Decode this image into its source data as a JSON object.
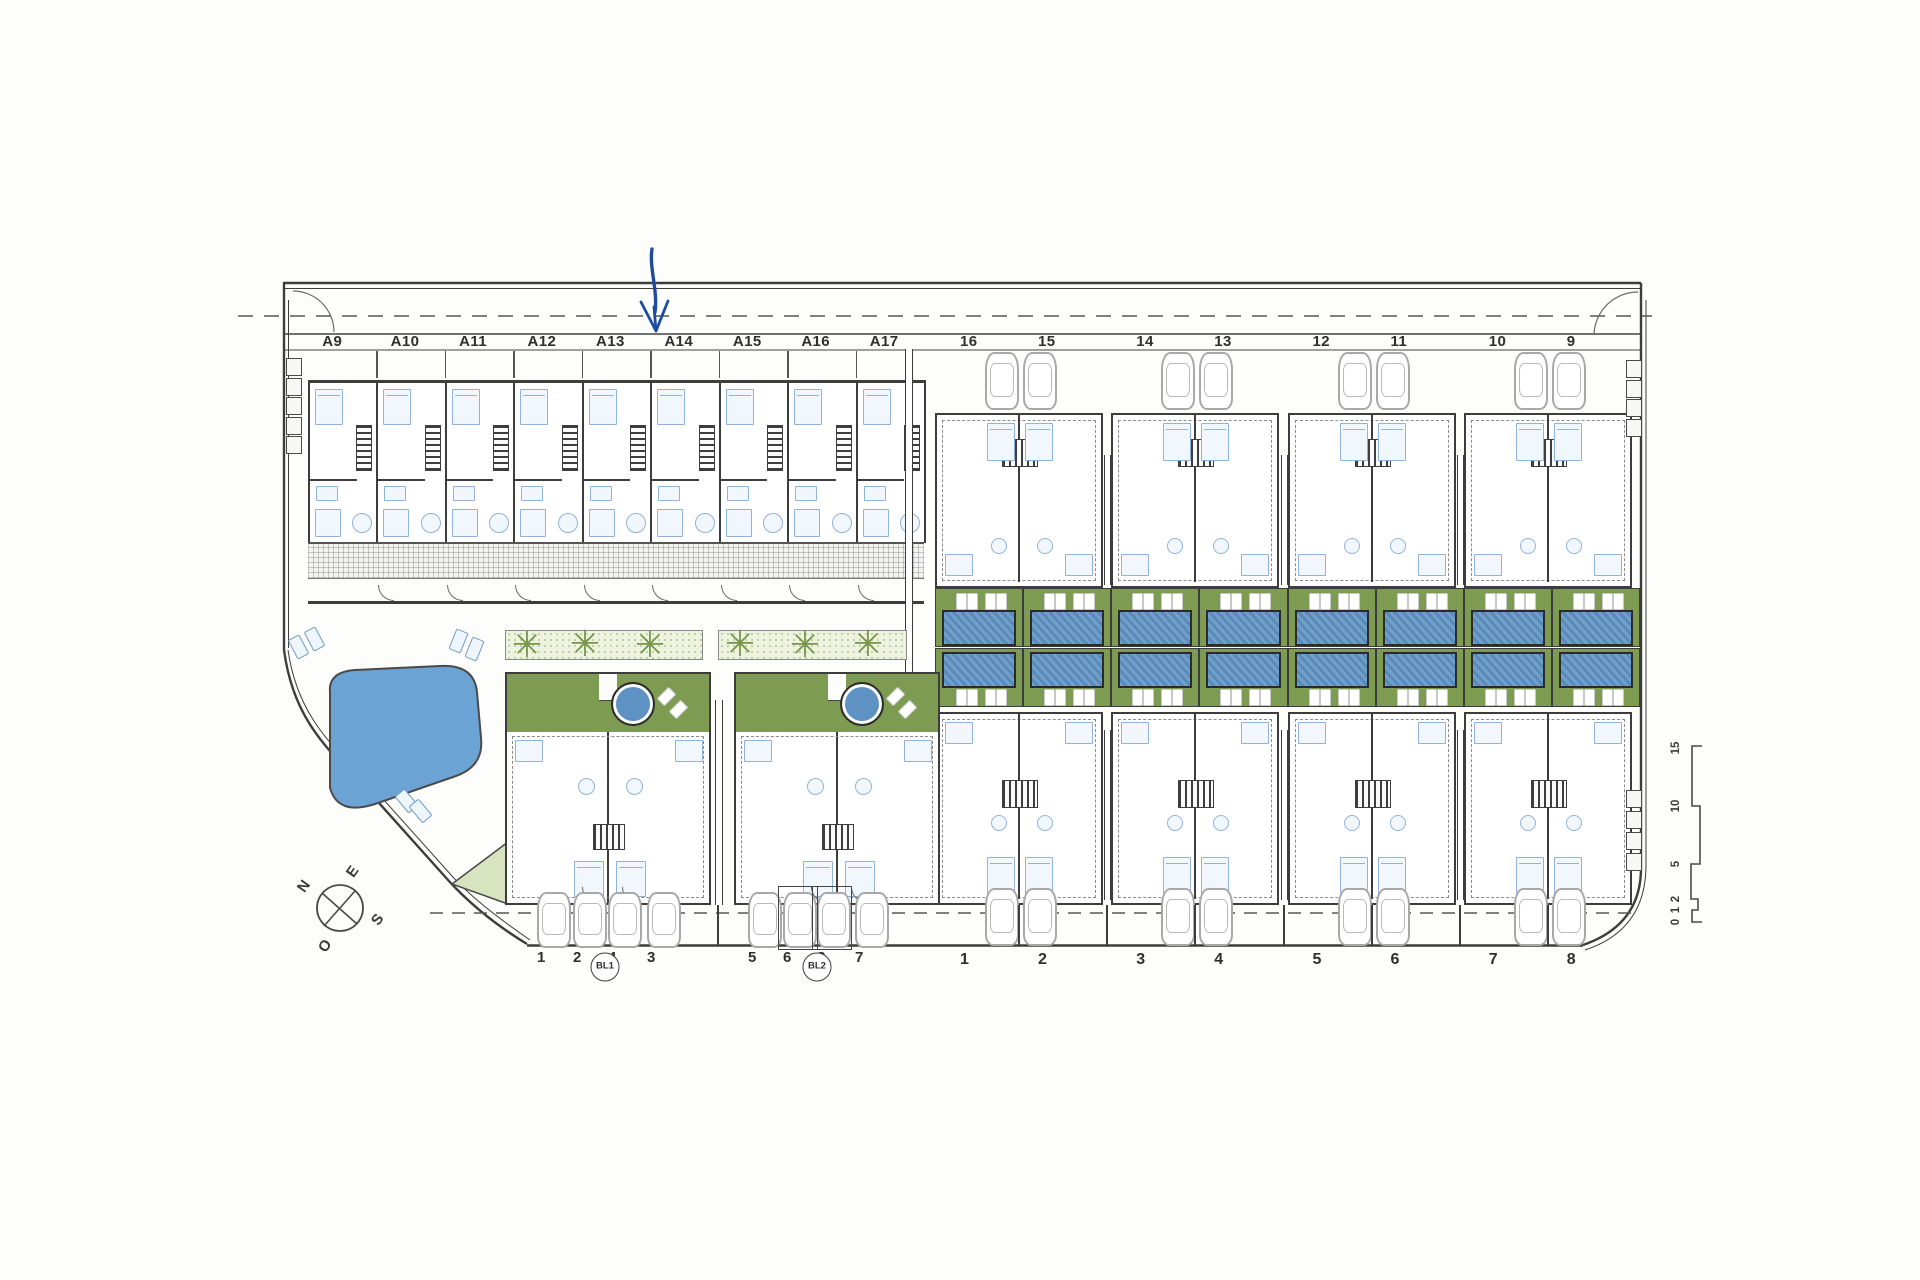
{
  "labels": {
    "upper_left_units": [
      "A9",
      "A10",
      "A11",
      "A12",
      "A13",
      "A14",
      "A15",
      "A16",
      "A17"
    ],
    "upper_right_units": [
      "16",
      "15",
      "14",
      "13",
      "12",
      "11",
      "10",
      "9"
    ],
    "lower_left_units": [
      "1",
      "2",
      "4",
      "3",
      "5",
      "6",
      "8",
      "7"
    ],
    "lower_left_block_tags": [
      "BL1",
      "BL2"
    ],
    "lower_right_units": [
      "1",
      "2",
      "3",
      "4",
      "5",
      "6",
      "7",
      "8"
    ]
  },
  "compass": {
    "north": "N",
    "east": "E",
    "south": "S",
    "west": "O"
  },
  "scale_bar": {
    "ticks": [
      "0",
      "1",
      "2",
      "5",
      "10",
      "15"
    ]
  },
  "icons": {
    "palm": "✳"
  },
  "colors": {
    "garden_green": "#7d9c52",
    "pool_blue": "#5e92c2",
    "pond_blue": "#6ba3d4",
    "annotation_blue": "#1d4c9f",
    "wall_dark": "#3d3d3d"
  }
}
